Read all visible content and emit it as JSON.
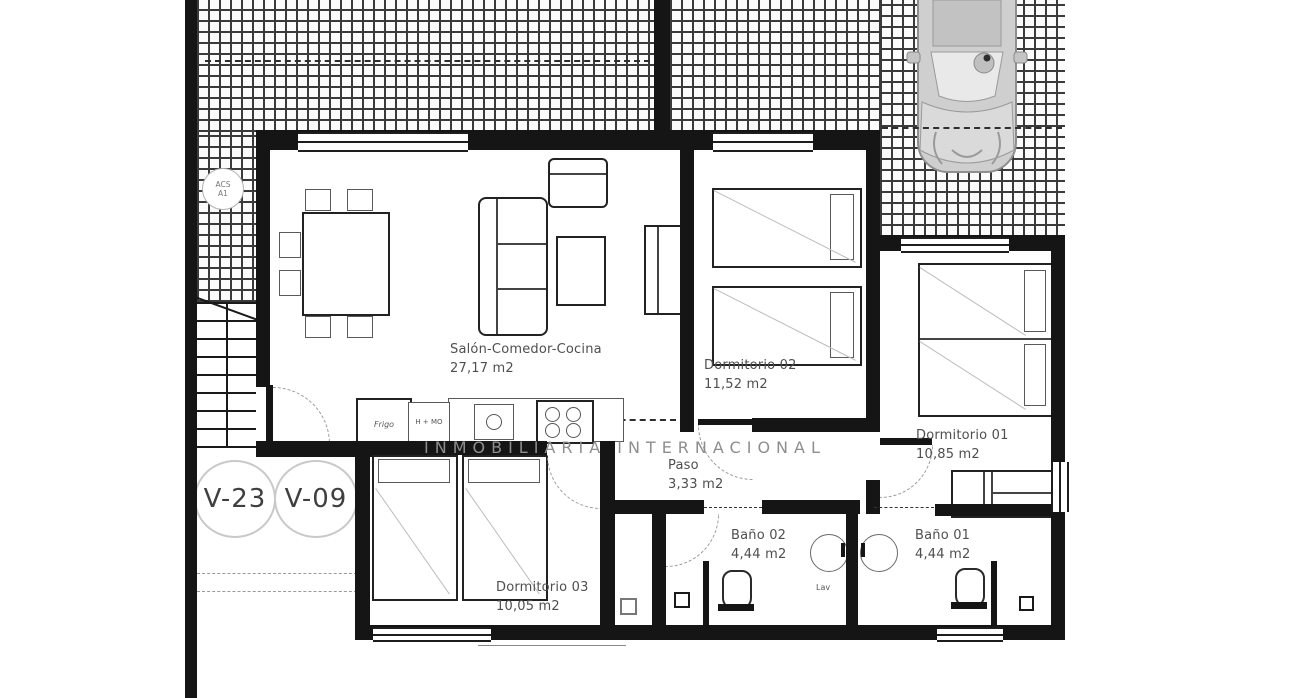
{
  "plan": {
    "watermark": "INMOBILIARIA INTERNACIONAL",
    "rooms": {
      "salon": {
        "name": "Salón-Comedor-Cocina",
        "area": "27,17 m2"
      },
      "dorm02": {
        "name": "Dormitorio 02",
        "area": "11,52 m2"
      },
      "dorm01": {
        "name": "Dormitorio 01",
        "area": "10,85 m2"
      },
      "paso": {
        "name": "Paso",
        "area": "3,33 m2"
      },
      "bano02": {
        "name": "Baño 02",
        "area": "4,44 m2"
      },
      "bano01": {
        "name": "Baño 01",
        "area": "4,44 m2"
      },
      "dorm03": {
        "name": "Dormitorio 03",
        "area": "10,05 m2"
      }
    },
    "annotations": {
      "acs_line1": "ACS",
      "acs_line2": "A1",
      "window_left": "V-23",
      "window_right": "V-09",
      "fridge": "Frigo",
      "oven_micro": "H + MO",
      "washer": "Lav"
    },
    "colors": {
      "wall": "#151515",
      "hatch_line": "#3a3a3a",
      "label_text": "#4f4f4f",
      "watermark": "#8e8e8e",
      "car_body": "#cfcfcf"
    }
  }
}
